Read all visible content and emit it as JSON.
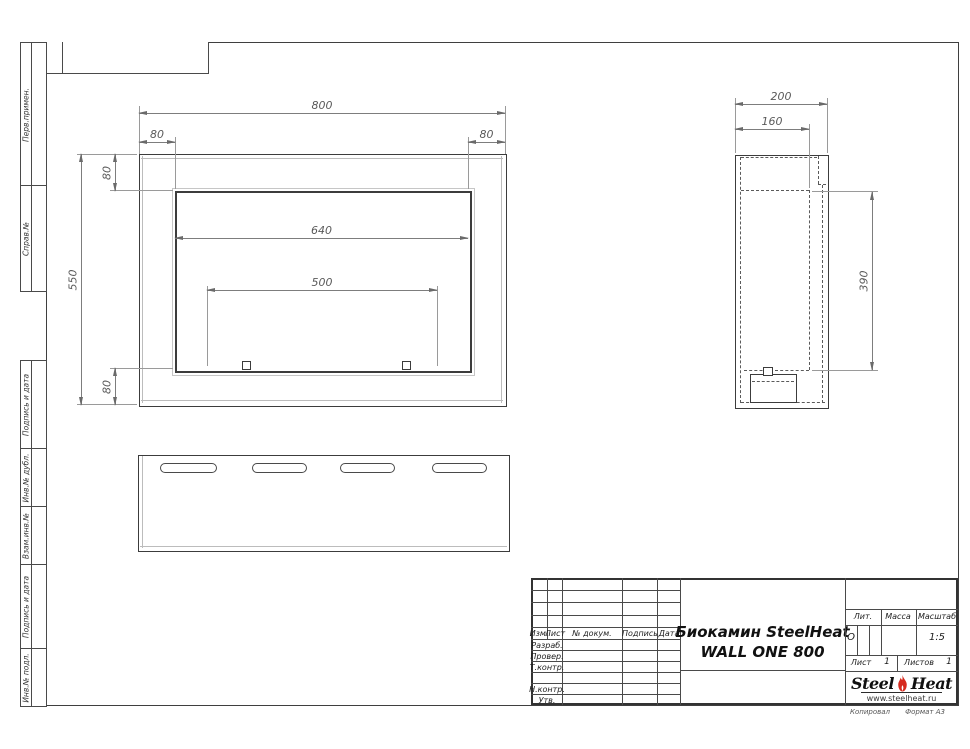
{
  "drawing": {
    "product": "Биокамин SteelHeat WALL ONE 800",
    "front_view": {
      "dim_width": "800",
      "dim_flange_left": "80",
      "dim_flange_right": "80",
      "dim_flange_top": "80",
      "dim_height": "550",
      "dim_flange_bottom": "80",
      "dim_opening_width": "640",
      "dim_burner_width": "500"
    },
    "side_view": {
      "dim_depth": "200",
      "dim_inner_depth": "160",
      "dim_opening_height": "390"
    }
  },
  "margin_stamps": {
    "top": [
      {
        "label": "Перв.примен."
      },
      {
        "label": "Справ.№"
      }
    ],
    "bottom": [
      {
        "label": "Подпись и дата"
      },
      {
        "label": "Инв.№ дубл."
      },
      {
        "label": "Взам.инв.№"
      },
      {
        "label": "Подпись и дата"
      },
      {
        "label": "Инв.№ подл."
      }
    ]
  },
  "title_block": {
    "header_cols": [
      {
        "label": "Изм."
      },
      {
        "label": "Лист"
      },
      {
        "label": "№ докум."
      },
      {
        "label": "Подпись"
      },
      {
        "label": "Дата"
      }
    ],
    "staff_rows": [
      {
        "label": "Разраб."
      },
      {
        "label": "Провер."
      },
      {
        "label": "Т.контр."
      },
      {
        "label": "Н.контр."
      },
      {
        "label": "Утв."
      }
    ],
    "title_line1": "Биокамин SteelHeat",
    "title_line2": "WALL ONE 800",
    "lit_label": "Лит.",
    "lit_value": "О",
    "mass_label": "Масса",
    "scale_label": "Масштаб",
    "scale_value": "1:5",
    "sheet_label": "Лист",
    "sheet_value": "1",
    "sheets_label": "Листов",
    "sheets_value": "1",
    "logo_part1": "Steel",
    "logo_part2": "Heat",
    "logo_site": "www.steelheat.ru",
    "footer_copy": "Копировал",
    "footer_format": "Формат А3"
  },
  "colors": {
    "logo_flame": "#d62a1e",
    "line_main": "#3c3c3c",
    "line_dim": "#7d7d7d"
  }
}
